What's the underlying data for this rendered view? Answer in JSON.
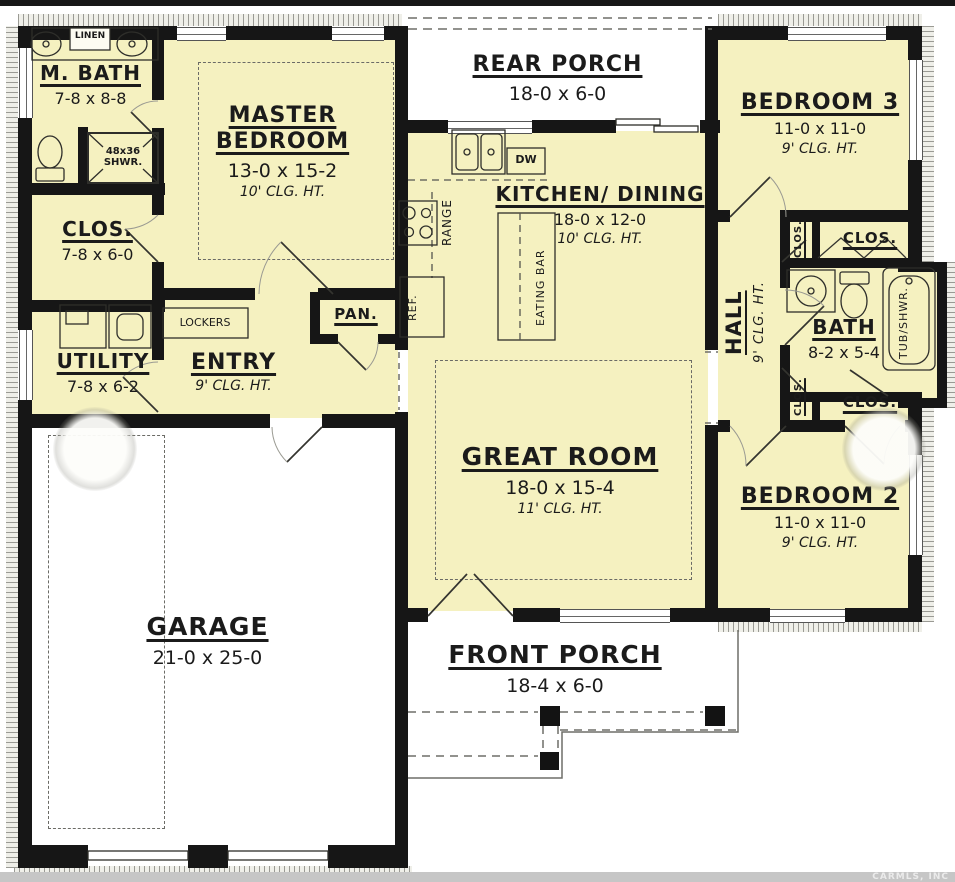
{
  "colors": {
    "room_fill": "#f5f1c0",
    "wall": "#161616",
    "porch_fill": "#ffffff",
    "watermark_bar": "#c6c6c6"
  },
  "labels": {
    "m_bath": {
      "name": "M. BATH",
      "dims": "7-8 x 8-8"
    },
    "linen": "LINEN",
    "shower": {
      "line1": "48x36",
      "line2": "SHWR."
    },
    "master_bedroom": {
      "name": "MASTER BEDROOM",
      "dims": "13-0 x 15-2",
      "clg": "10' CLG. HT."
    },
    "clos_master": {
      "name": "CLOS.",
      "dims": "7-8 x 6-0"
    },
    "utility": {
      "name": "UTILITY",
      "dims": "7-8 x 6-2"
    },
    "lockers": "LOCKERS",
    "entry": {
      "name": "ENTRY",
      "clg": "9' CLG. HT."
    },
    "pan": "PAN.",
    "rear_porch": {
      "name": "REAR PORCH",
      "dims": "18-0 x 6-0"
    },
    "kitchen": {
      "name": "KITCHEN/ DINING",
      "dims": "18-0 x 12-0",
      "clg": "10' CLG. HT."
    },
    "range": "RANGE",
    "ref": "REF.",
    "dw": "DW",
    "eating_bar": "EATING BAR",
    "great_room": {
      "name": "GREAT ROOM",
      "dims": "18-0 x 15-4",
      "clg": "11' CLG. HT."
    },
    "bedroom3": {
      "name": "BEDROOM 3",
      "dims": "11-0 x 11-0",
      "clg": "9' CLG. HT."
    },
    "bedroom2": {
      "name": "BEDROOM 2",
      "dims": "11-0 x 11-0",
      "clg": "9' CLG. HT."
    },
    "hall": {
      "name": "HALL",
      "clg": "9' CLG. HT."
    },
    "bath": {
      "name": "BATH",
      "dims": "8-2 x 5-4"
    },
    "tub": "TUB/SHWR.",
    "clos_top_v": "CLOS.",
    "clos_top": "CLOS.",
    "clos_bot_v": "CLOS.",
    "clos_bot": "CLOS.",
    "garage": {
      "name": "GARAGE",
      "dims": "21-0 x 25-0"
    },
    "front_porch": {
      "name": "FRONT PORCH",
      "dims": "18-4 x 6-0"
    },
    "watermark": "CARMLS, INC"
  }
}
